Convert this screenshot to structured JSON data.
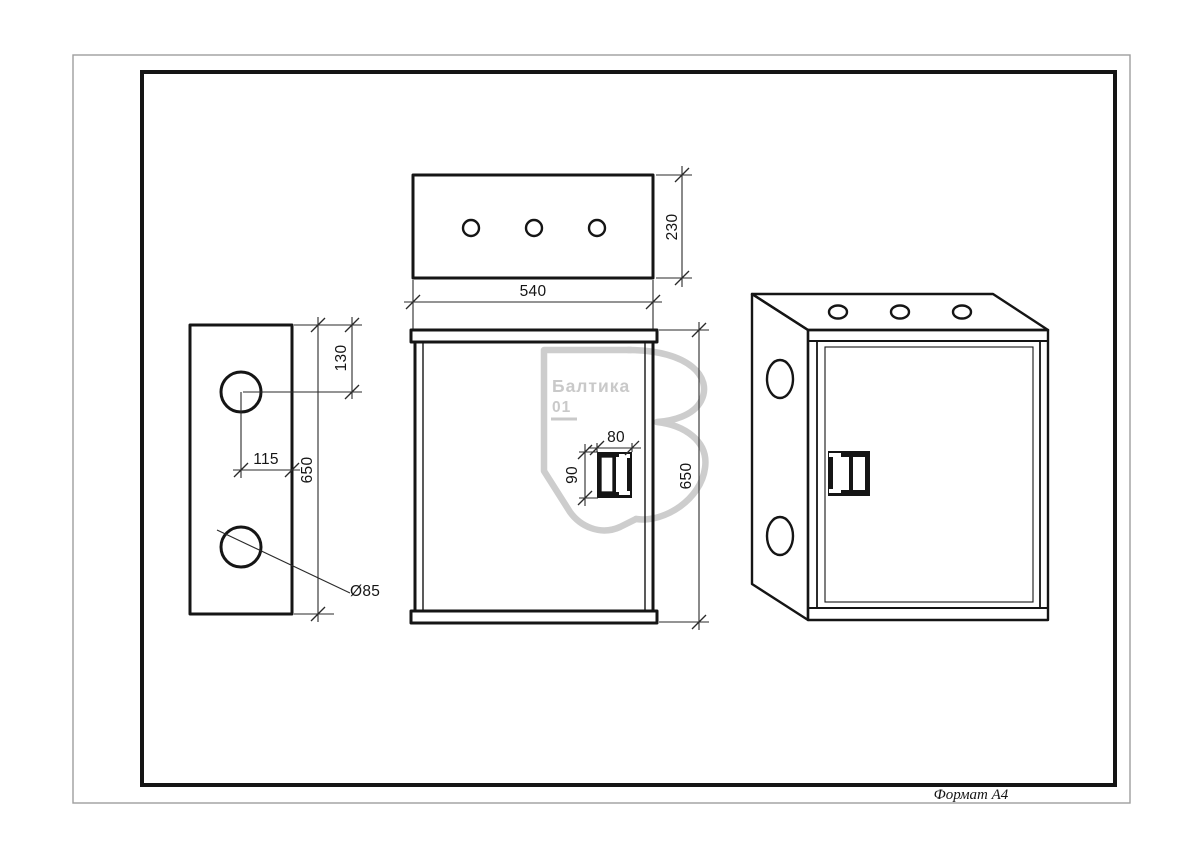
{
  "sheet": {
    "format_label": "Формат А4",
    "background": "#ffffff",
    "border_outer_color": "#9e9e9e",
    "line_color": "#151515"
  },
  "watermark": {
    "brand": "Балтика",
    "number": "01",
    "color": "#c9c9c9"
  },
  "dims": {
    "top_depth": "230",
    "top_width": "540",
    "side_hole_top_offset": "130",
    "side_hole_center_offset": "115",
    "side_height": "650",
    "side_hole_diameter": "Ø85",
    "handle_width": "80",
    "handle_height": "90",
    "front_height": "650"
  }
}
